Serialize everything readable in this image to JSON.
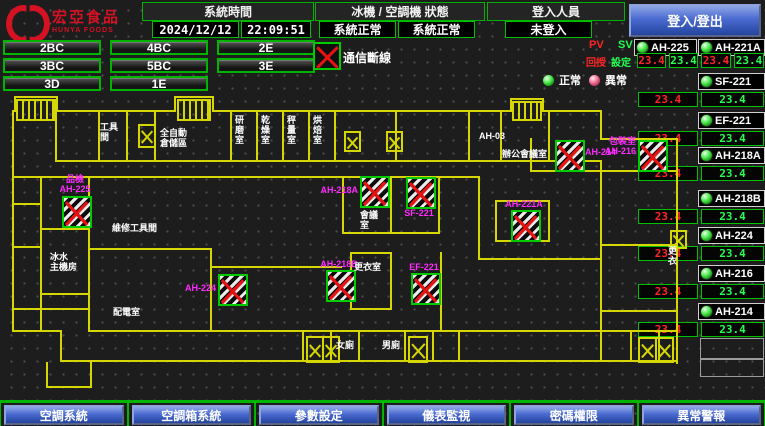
{
  "header": {
    "logo": {
      "name": "宏亞食品",
      "sub": "HUNYA FOODS"
    },
    "system_time_label": "系統時間",
    "date": "2024/12/12",
    "time": "22:09:51",
    "machine_status_label": "冰機 / 空調機 狀態",
    "chiller_status": "系統正常",
    "ahu_status": "系統正常",
    "login_label": "登入人員",
    "login_status": "未登入",
    "login_button": "登入/登出"
  },
  "floor_buttons": [
    "2BC",
    "4BC",
    "2E",
    "3BC",
    "5BC",
    "3E",
    "3D",
    "1E"
  ],
  "legend": {
    "comm_loss": "通信斷線",
    "normal": "正常",
    "abnormal": "異常",
    "pv": "PV",
    "sv": "SV",
    "feedback": "回授",
    "setpoint": "設定"
  },
  "units": {
    "paired": [
      {
        "name": "AH-225",
        "pv": "23.4",
        "sv": "23.4"
      },
      {
        "name": "AH-221A",
        "pv": "23.4",
        "sv": "23.4"
      }
    ],
    "singles": [
      {
        "name": "SF-221",
        "pv": "23.4",
        "sv": "23.4"
      },
      {
        "name": "EF-221",
        "pv": "23.4",
        "sv": "23.4"
      },
      {
        "name": "AH-218A",
        "pv": "23.4",
        "sv": "23.4"
      },
      {
        "name": "AH-218B",
        "pv": "23.4",
        "sv": "23.4"
      },
      {
        "name": "AH-224",
        "pv": "23.4",
        "sv": "23.4"
      },
      {
        "name": "AH-216",
        "pv": "23.4",
        "sv": "23.4"
      },
      {
        "name": "AH-214",
        "pv": "23.4",
        "sv": "23.4"
      }
    ]
  },
  "floorplan": {
    "markers": [
      {
        "name": "AH-225",
        "room": "品檢",
        "x": 62,
        "y": 196,
        "label_pos": "above"
      },
      {
        "name": "AH-224",
        "room": "",
        "x": 218,
        "y": 274,
        "label_pos": "left"
      },
      {
        "name": "AH-218A",
        "room": "",
        "x": 360,
        "y": 176,
        "label_pos": "left"
      },
      {
        "name": "SF-221",
        "room": "",
        "x": 406,
        "y": 177,
        "label_pos": "below"
      },
      {
        "name": "AH-221A",
        "room": "",
        "x": 511,
        "y": 210,
        "label_pos": "above"
      },
      {
        "name": "AH-214",
        "room": "",
        "x": 555,
        "y": 140,
        "label_pos": "right"
      },
      {
        "name": "AH-216",
        "room": "包裝室",
        "x": 638,
        "y": 140,
        "label_pos": "left"
      },
      {
        "name": "AH-218B",
        "room": "",
        "x": 326,
        "y": 270,
        "label_pos": "above"
      },
      {
        "name": "EF-221",
        "room": "",
        "x": 411,
        "y": 273,
        "label_pos": "above"
      }
    ],
    "room_labels": [
      {
        "text": "工具\n間",
        "x": 100,
        "y": 122
      },
      {
        "text": "全自動\n倉儲區",
        "x": 160,
        "y": 128
      },
      {
        "text": "研磨室",
        "x": 234,
        "y": 115,
        "vertical": true
      },
      {
        "text": "乾燥室",
        "x": 260,
        "y": 115,
        "vertical": true
      },
      {
        "text": "秤量室",
        "x": 286,
        "y": 115,
        "vertical": true
      },
      {
        "text": "烘焙室",
        "x": 312,
        "y": 115,
        "vertical": true
      },
      {
        "text": "AH-03",
        "x": 479,
        "y": 131
      },
      {
        "text": "辦公會議室",
        "x": 502,
        "y": 149
      },
      {
        "text": "會議\n室",
        "x": 360,
        "y": 210
      },
      {
        "text": "更衣室",
        "x": 354,
        "y": 262
      },
      {
        "text": "冰水\n主機房",
        "x": 50,
        "y": 252
      },
      {
        "text": "維修工具間",
        "x": 112,
        "y": 223
      },
      {
        "text": "配電室",
        "x": 113,
        "y": 307
      },
      {
        "text": "女廁",
        "x": 336,
        "y": 340
      },
      {
        "text": "男廁",
        "x": 382,
        "y": 340
      },
      {
        "text": "更衣",
        "x": 667,
        "y": 246,
        "vertical": true
      }
    ]
  },
  "footer_buttons": [
    "空調系統",
    "空調箱系統",
    "參數設定",
    "儀表監視",
    "密碼權限",
    "異常警報"
  ],
  "colors": {
    "accent_green": "#00b400",
    "wall_yellow": "#d6d600",
    "pv_red": "#ff2525",
    "sv_green": "#25ff50",
    "marker_magenta": "#ff2bff",
    "button_blue": "#4a6ad0"
  }
}
